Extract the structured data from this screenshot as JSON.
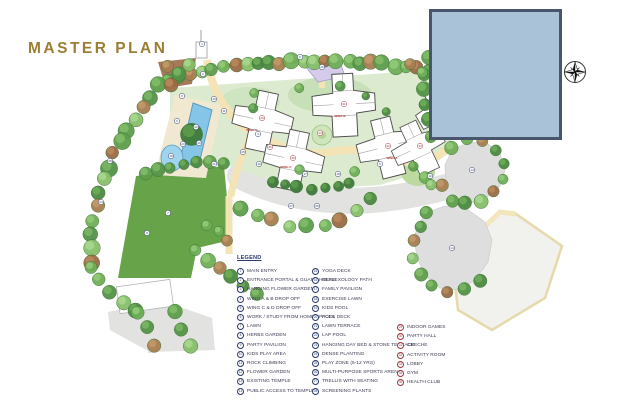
{
  "title": "MASTER PLAN",
  "legend": {
    "heading": "LEGEND",
    "columns": [
      [
        {
          "n": "1",
          "label": "MAIN ENTRY"
        },
        {
          "n": "2",
          "label": "ENTRANCE PORTAL & GUARD HOUSE"
        },
        {
          "n": "3",
          "label": "HANGING FLOWER GARDEN"
        },
        {
          "n": "4",
          "label": "WING A & B DROP OFF"
        },
        {
          "n": "5",
          "label": "WING C & D DROP OFF"
        },
        {
          "n": "6",
          "label": "WORK / STUDY FROM HOME SPACES"
        },
        {
          "n": "7",
          "label": "LAWN"
        },
        {
          "n": "8",
          "label": "HERBS GARDEN"
        },
        {
          "n": "9",
          "label": "PARTY PAVILION"
        },
        {
          "n": "10",
          "label": "KIDS PLAY AREA"
        },
        {
          "n": "11",
          "label": "ROCK CLIMBING"
        },
        {
          "n": "12",
          "label": "FLOWER GARDEN"
        },
        {
          "n": "13",
          "label": "EXISTING TEMPLE"
        },
        {
          "n": "14",
          "label": "PUBLIC ACCESS TO TEMPLE"
        }
      ],
      [
        {
          "n": "15",
          "label": "YOGA DECK"
        },
        {
          "n": "16",
          "label": "REFLEXOLOGY PATH"
        },
        {
          "n": "17",
          "label": "FAMILY PAVILION"
        },
        {
          "n": "18",
          "label": "EXERCISE LAWN"
        },
        {
          "n": "19",
          "label": "KIDS POOL"
        },
        {
          "n": "20",
          "label": "POOL DECK"
        },
        {
          "n": "21",
          "label": "LAWN TERRACE"
        },
        {
          "n": "22",
          "label": "LAP POOL"
        },
        {
          "n": "23",
          "label": "HANGING DAY BED & STONE TERRACE"
        },
        {
          "n": "24",
          "label": "DENSE PLANTING"
        },
        {
          "n": "25",
          "label": "PLAY ZONE (5-12 YRS)"
        },
        {
          "n": "26",
          "label": "MULTI-PURPOSE SPORTS ARENA"
        },
        {
          "n": "27",
          "label": "TRELLIS WITH SEATING"
        },
        {
          "n": "28",
          "label": "SCREENING PLANTS"
        }
      ],
      [
        {
          "n": "29",
          "label": "INDOOR GAMES"
        },
        {
          "n": "30",
          "label": "PARTY HALL"
        },
        {
          "n": "31",
          "label": "CRECHE"
        },
        {
          "n": "32",
          "label": "ACTIVITY ROOM"
        },
        {
          "n": "33",
          "label": "LOBBY"
        },
        {
          "n": "34",
          "label": "GYM"
        },
        {
          "n": "35",
          "label": "HEALTH CLUB"
        }
      ]
    ]
  },
  "wings": [
    {
      "label": "WING D",
      "x": 252,
      "y": 131
    },
    {
      "label": "WING C",
      "x": 286,
      "y": 168
    },
    {
      "label": "WING B",
      "x": 340,
      "y": 117
    },
    {
      "label": "WING A",
      "x": 392,
      "y": 159
    }
  ],
  "map_markers": [
    {
      "n": "1",
      "x": 202,
      "y": 44,
      "t": "o"
    },
    {
      "n": "2",
      "x": 203,
      "y": 74,
      "t": "o"
    },
    {
      "n": "3",
      "x": 182,
      "y": 96,
      "t": "o"
    },
    {
      "n": "4",
      "x": 258,
      "y": 134,
      "t": "o"
    },
    {
      "n": "5",
      "x": 380,
      "y": 164,
      "t": "o"
    },
    {
      "n": "6",
      "x": 300,
      "y": 57,
      "t": "o"
    },
    {
      "n": "7",
      "x": 168,
      "y": 213,
      "t": "o"
    },
    {
      "n": "8",
      "x": 147,
      "y": 233,
      "t": "o"
    },
    {
      "n": "9",
      "x": 177,
      "y": 121,
      "t": "o"
    },
    {
      "n": "10",
      "x": 214,
      "y": 99,
      "t": "o"
    },
    {
      "n": "11",
      "x": 224,
      "y": 111,
      "t": "o"
    },
    {
      "n": "12",
      "x": 430,
      "y": 176,
      "t": "o"
    },
    {
      "n": "13",
      "x": 472,
      "y": 170,
      "t": "o"
    },
    {
      "n": "14",
      "x": 452,
      "y": 248,
      "t": "o"
    },
    {
      "n": "15",
      "x": 243,
      "y": 152,
      "t": "o"
    },
    {
      "n": "16",
      "x": 259,
      "y": 164,
      "t": "o"
    },
    {
      "n": "17",
      "x": 305,
      "y": 174,
      "t": "o"
    },
    {
      "n": "18",
      "x": 338,
      "y": 174,
      "t": "o"
    },
    {
      "n": "19",
      "x": 171,
      "y": 156,
      "t": "o"
    },
    {
      "n": "20",
      "x": 199,
      "y": 143,
      "t": "o"
    },
    {
      "n": "21",
      "x": 214,
      "y": 164,
      "t": "o"
    },
    {
      "n": "22",
      "x": 196,
      "y": 127,
      "t": "o"
    },
    {
      "n": "23",
      "x": 183,
      "y": 144,
      "t": "o"
    },
    {
      "n": "24",
      "x": 101,
      "y": 202,
      "t": "o"
    },
    {
      "n": "25",
      "x": 317,
      "y": 206,
      "t": "o"
    },
    {
      "n": "26",
      "x": 322,
      "y": 67,
      "t": "o"
    },
    {
      "n": "27",
      "x": 291,
      "y": 206,
      "t": "o"
    },
    {
      "n": "28",
      "x": 110,
      "y": 161,
      "t": "o"
    },
    {
      "n": "29",
      "x": 262,
      "y": 118,
      "t": "i"
    },
    {
      "n": "30",
      "x": 293,
      "y": 158,
      "t": "i"
    },
    {
      "n": "31",
      "x": 344,
      "y": 104,
      "t": "i"
    },
    {
      "n": "32",
      "x": 388,
      "y": 146,
      "t": "i"
    },
    {
      "n": "33",
      "x": 320,
      "y": 133,
      "t": "i"
    },
    {
      "n": "34",
      "x": 420,
      "y": 146,
      "t": "i"
    },
    {
      "n": "35",
      "x": 270,
      "y": 147,
      "t": "i"
    }
  ],
  "colors": {
    "title_gold": "#9c7e33",
    "legend_marker_outdoor": "#2b3a6b",
    "legend_marker_indoor": "#a03540",
    "masked_panel_fill": "#a9c2d8",
    "masked_panel_border": "#47566b",
    "lawn_green": "#67a348",
    "courtyard_green": "#dcead0",
    "pool_blue": "#85c6e8",
    "road_gray": "#e2e2e0",
    "path_cream": "#f3e3b5",
    "wing_label_red": "#b03030"
  }
}
